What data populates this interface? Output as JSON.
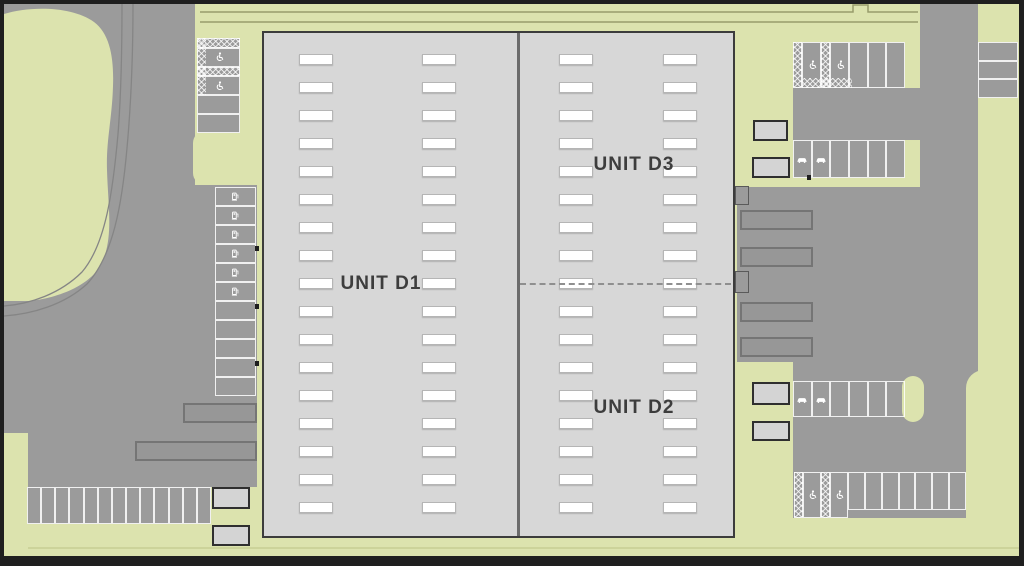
{
  "site": {
    "units": [
      {
        "id": "d1",
        "label": "UNIT D1"
      },
      {
        "id": "d3",
        "label": "UNIT D3"
      },
      {
        "id": "d2",
        "label": "UNIT D2"
      }
    ],
    "building": {
      "roof_vent_columns": 4,
      "roof_vent_rows": 17
    },
    "colors": {
      "landscape": "#dce3ae",
      "paving": "#9b9b9b",
      "building_fill": "#d7d7d7",
      "building_outline": "#3c3c3c",
      "bay_marking": "#ffffff",
      "frame": "#1f1f1f",
      "label_text": "#3d3d3d"
    },
    "parking_groups": [
      {
        "id": "nw-block",
        "bays": [
          "hatch",
          "accessible",
          "hatch",
          "accessible",
          "standard",
          "standard"
        ]
      },
      {
        "id": "west-column",
        "bays": [
          "ev",
          "ev",
          "ev",
          "ev",
          "ev",
          "ev",
          "standard",
          "standard",
          "standard",
          "standard",
          "standard"
        ]
      },
      {
        "id": "southwest-row",
        "bays": [
          "standard",
          "standard",
          "standard",
          "standard",
          "standard",
          "standard",
          "standard",
          "standard",
          "standard",
          "standard",
          "standard",
          "standard",
          "standard"
        ]
      },
      {
        "id": "northeast-block",
        "bays": [
          "hatch",
          "accessible",
          "hatch",
          "accessible",
          "standard",
          "standard",
          "standard"
        ]
      },
      {
        "id": "northeast-ev-row",
        "bays": [
          "car",
          "car",
          "standard",
          "standard",
          "standard",
          "standard"
        ]
      },
      {
        "id": "east-mid-row",
        "bays": [
          "car",
          "car",
          "standard",
          "standard",
          "standard",
          "standard"
        ]
      },
      {
        "id": "southeast-accessible",
        "bays": [
          "hatch",
          "accessible",
          "hatch",
          "accessible"
        ]
      },
      {
        "id": "southeast-row",
        "bays": [
          "standard",
          "standard",
          "standard",
          "standard",
          "standard",
          "standard",
          "standard"
        ]
      },
      {
        "id": "far-east-column",
        "bays": [
          "standard",
          "standard",
          "standard"
        ]
      }
    ],
    "icons": [
      {
        "name": "wheelchair-icon",
        "meaning": "accessible parking bay"
      },
      {
        "name": "ev-charger-icon",
        "meaning": "EV charging bay"
      },
      {
        "name": "car-icon",
        "meaning": "car charging bay"
      }
    ]
  }
}
